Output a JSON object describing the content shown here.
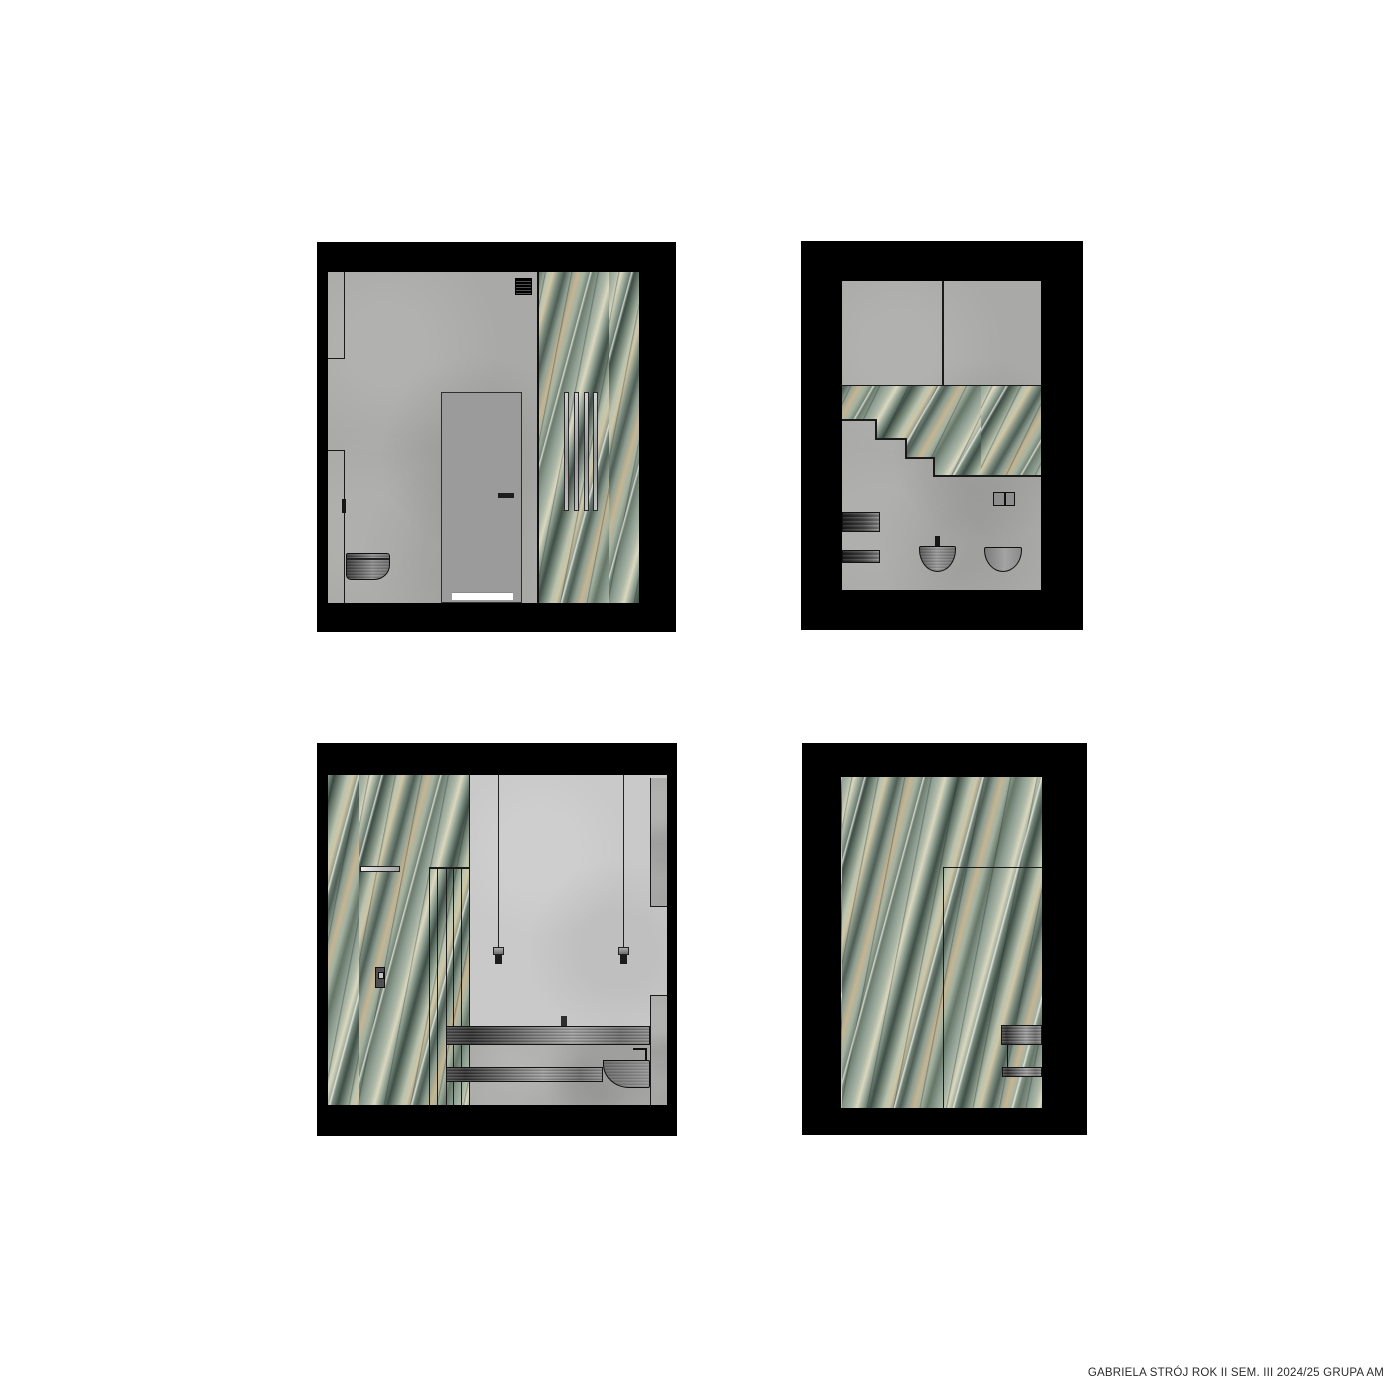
{
  "footer": {
    "credit": "GABRIELA STRÓJ ROK II SEM. III 2024/25 GRUPA AM"
  },
  "palette": {
    "page_background": "#ffffff",
    "frame_black": "#000000",
    "concrete_grey": "#a9a9a7",
    "light_wall_grey": "#c9c9c9",
    "door_grey": "#9b9b9b",
    "fixture_metal_dark": "#2e2e2e",
    "fixture_metal_light": "#9e9e9e",
    "marble_sage": "#aeb9a8",
    "marble_green_dark": "#404f47",
    "marble_cream": "#dbd8bf",
    "marble_tan": "#c5b593",
    "vein_white": "#fcfcf6"
  },
  "panels": [
    {
      "depicts": "bathroom elevation: concrete wall, pocket door, vent grille, wall-hung toilet, vertical slats over green marble wall"
    },
    {
      "depicts": "bathroom elevation: concrete walls with stepped green marble band (stair profile), two towel radiators, wall socket, bidet and vessel basin"
    },
    {
      "depicts": "bathroom elevation: green marble shower wall with glass partition and control, pendant lights, metal vanity counter, shelf and wall basin"
    },
    {
      "depicts": "bathroom elevation: full-height green marble wall with glass enclosure outline and two metal shelves"
    }
  ]
}
